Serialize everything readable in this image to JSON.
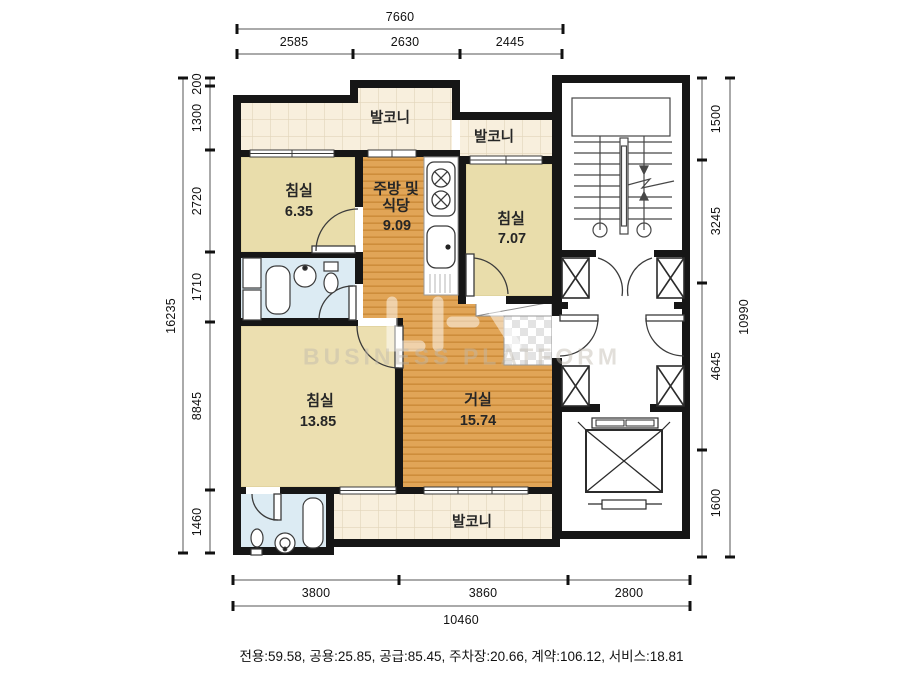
{
  "title": "apartment-floor-plan",
  "rooms": {
    "balcony_top": {
      "name": "발코니"
    },
    "balcony_top_right": {
      "name": "발코니"
    },
    "balcony_bottom": {
      "name": "발코니"
    },
    "bedroom_small": {
      "name": "침실",
      "area": "6.35"
    },
    "kitchen": {
      "name_line1": "주방 및",
      "name_line2": "식당",
      "area": "9.09"
    },
    "bedroom_right": {
      "name": "침실",
      "area": "7.07"
    },
    "bedroom_large": {
      "name": "침실",
      "area": "13.85"
    },
    "living": {
      "name": "거실",
      "area": "15.74"
    }
  },
  "dimensions": {
    "top": {
      "total": "7660",
      "segments": [
        "2585",
        "2630",
        "2445"
      ]
    },
    "left": {
      "total": "16235",
      "segments": [
        "200",
        "1300",
        "2720",
        "1710",
        "8845",
        "1460"
      ]
    },
    "right": {
      "total": "10990",
      "segments": [
        "1500",
        "3245",
        "4645",
        "1600"
      ]
    },
    "bottom": {
      "total": "10460",
      "segments": [
        "3800",
        "3860",
        "2800"
      ]
    }
  },
  "footer": {
    "summary": "전용:59.58, 공용:25.85, 공급:85.45, 주차장:20.66, 계약:106.12, 서비스:18.81"
  },
  "watermark": {
    "text": "BUSINESS PLATFORM"
  },
  "colors": {
    "wall": "#161616",
    "balcony_floor": "#f8efdd",
    "bedroom_floor": "#e9ddab",
    "wood_floor": "#e1a557",
    "bath_floor": "#dcebf3",
    "line": "#3b3b3b"
  }
}
